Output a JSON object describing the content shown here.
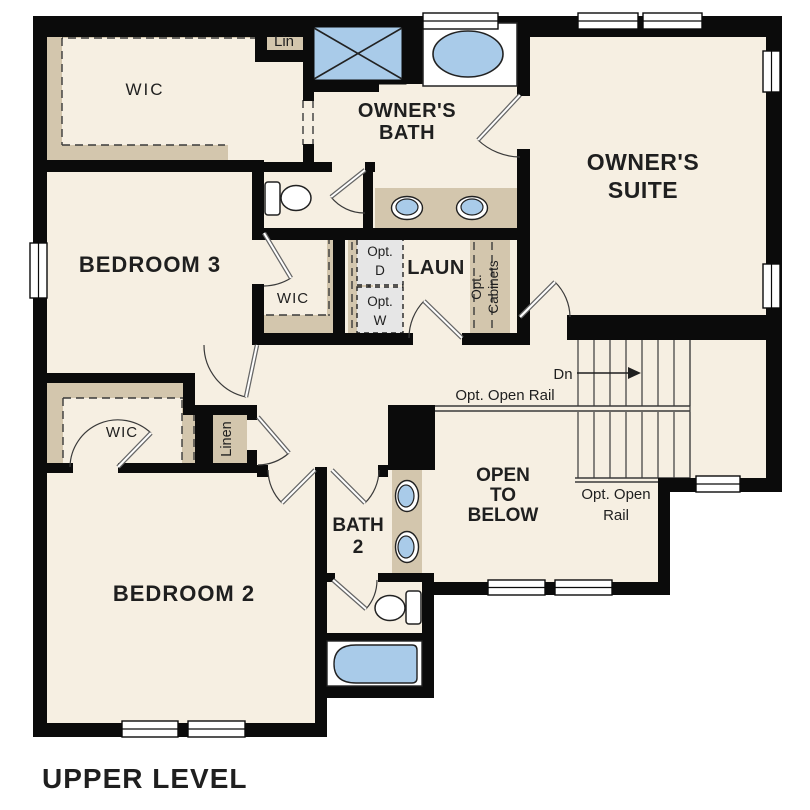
{
  "title": "UPPER LEVEL",
  "colors": {
    "floor": "#f6efe2",
    "shelf": "#d3c6ad",
    "wall": "#0b0b0b",
    "fixture_blue": "#a9cbe9",
    "outline": "#222222",
    "optional_gray": "#e6e6e6",
    "window_white": "#ffffff",
    "text": "#1f1f1f",
    "stair_line": "#3a3a3a",
    "door_leaf": "#666666"
  },
  "labels": {
    "owner_wic": "WIC",
    "lin_closet": "Lin",
    "owners_bath": [
      "OWNER'S",
      "BATH"
    ],
    "owners_suite": [
      "OWNER'S",
      "SUITE"
    ],
    "bedroom3": "BEDROOM 3",
    "bed3_wic": "WIC",
    "opt_dryer": [
      "Opt.",
      "D"
    ],
    "laundry": "LAUN",
    "opt_washer": [
      "Opt.",
      "W"
    ],
    "opt_cabinets": [
      "Opt.",
      "Cabinets"
    ],
    "down": "Dn",
    "opt_open_rail_top": "Opt. Open Rail",
    "bed2_wic": "WIC",
    "linen": "Linen",
    "open_to_below": [
      "OPEN",
      "TO",
      "BELOW"
    ],
    "opt_open_rail_side": [
      "Opt. Open",
      "Rail"
    ],
    "bath2": [
      "BATH",
      "2"
    ],
    "bedroom2": "BEDROOM 2"
  }
}
